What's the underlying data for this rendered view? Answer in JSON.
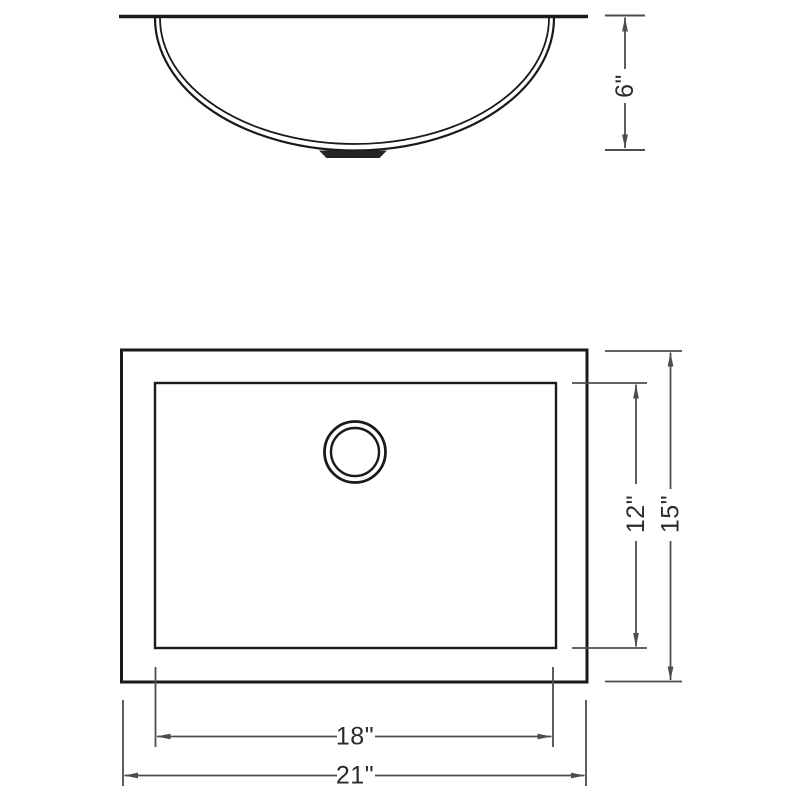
{
  "dimensions": {
    "bowl_depth": "6\"",
    "basin_width": "12\"",
    "overall_width": "15\"",
    "basin_length": "18\"",
    "overall_length": "21\""
  },
  "colors": {
    "drawing_line": "#1a1a1a",
    "dimension_line": "#4d4d4d",
    "label_text": "#2b2b2b",
    "background": "#ffffff"
  }
}
